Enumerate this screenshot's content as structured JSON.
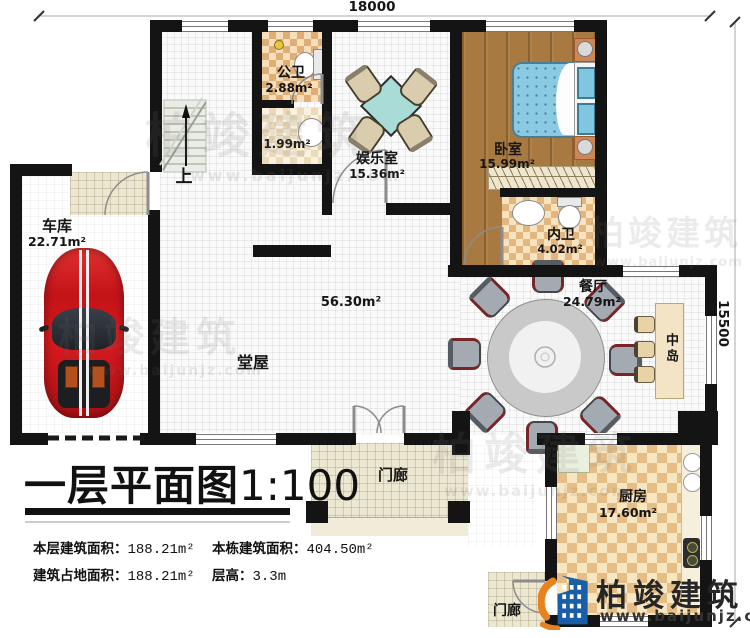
{
  "plan": {
    "dimensions": {
      "width_mm": "18000",
      "depth_mm": "15500"
    },
    "rooms": {
      "garage": {
        "name": "车库",
        "area": "22.71m²"
      },
      "public_bath": {
        "name": "公卫",
        "area": "2.88m²"
      },
      "hall_bath": {
        "area": "1.99m²"
      },
      "entertainment": {
        "name": "娱乐室",
        "area": "15.36m²"
      },
      "bedroom": {
        "name": "卧室",
        "area": "15.99m²"
      },
      "ensuite_bath": {
        "name": "内卫",
        "area": "4.02m²"
      },
      "main_hall": {
        "name": "堂屋",
        "area": "56.30m²"
      },
      "dining": {
        "name": "餐厅",
        "area": "24.79m²"
      },
      "island": {
        "name": "中岛"
      },
      "kitchen": {
        "name": "厨房",
        "area": "17.60m²"
      },
      "porch_front": {
        "name": "门廊"
      },
      "porch_side": {
        "name": "门廊"
      }
    },
    "stairs": {
      "direction_label": "上"
    }
  },
  "title_block": {
    "title": "一层平面图",
    "scale": "1:100",
    "stats": [
      {
        "label": "本层建筑面积：",
        "value": "188.21m²"
      },
      {
        "label": "建筑占地面积：",
        "value": "188.21m²"
      },
      {
        "label": "本栋建筑面积：",
        "value": "404.50m²"
      },
      {
        "label": "层高：",
        "value": "3.3m"
      }
    ]
  },
  "branding": {
    "logo_name": "柏竣建筑",
    "logo_url": "www.baijunjz.com",
    "watermark_name": "柏竣建筑",
    "watermark_url": "www.baijunjz.com"
  },
  "colors": {
    "wall": "#141414",
    "wood_floor": "#a87a42",
    "tile_dark": "#e0b080",
    "tile_light": "#f5e3c0",
    "porch_tile": "#ece7d1",
    "car_red": "#c41318",
    "bed_blue": "#8acae2",
    "table_teal": "#a9dcd6",
    "logo_blue": "#1a5ea8",
    "logo_orange": "#e8821e"
  }
}
